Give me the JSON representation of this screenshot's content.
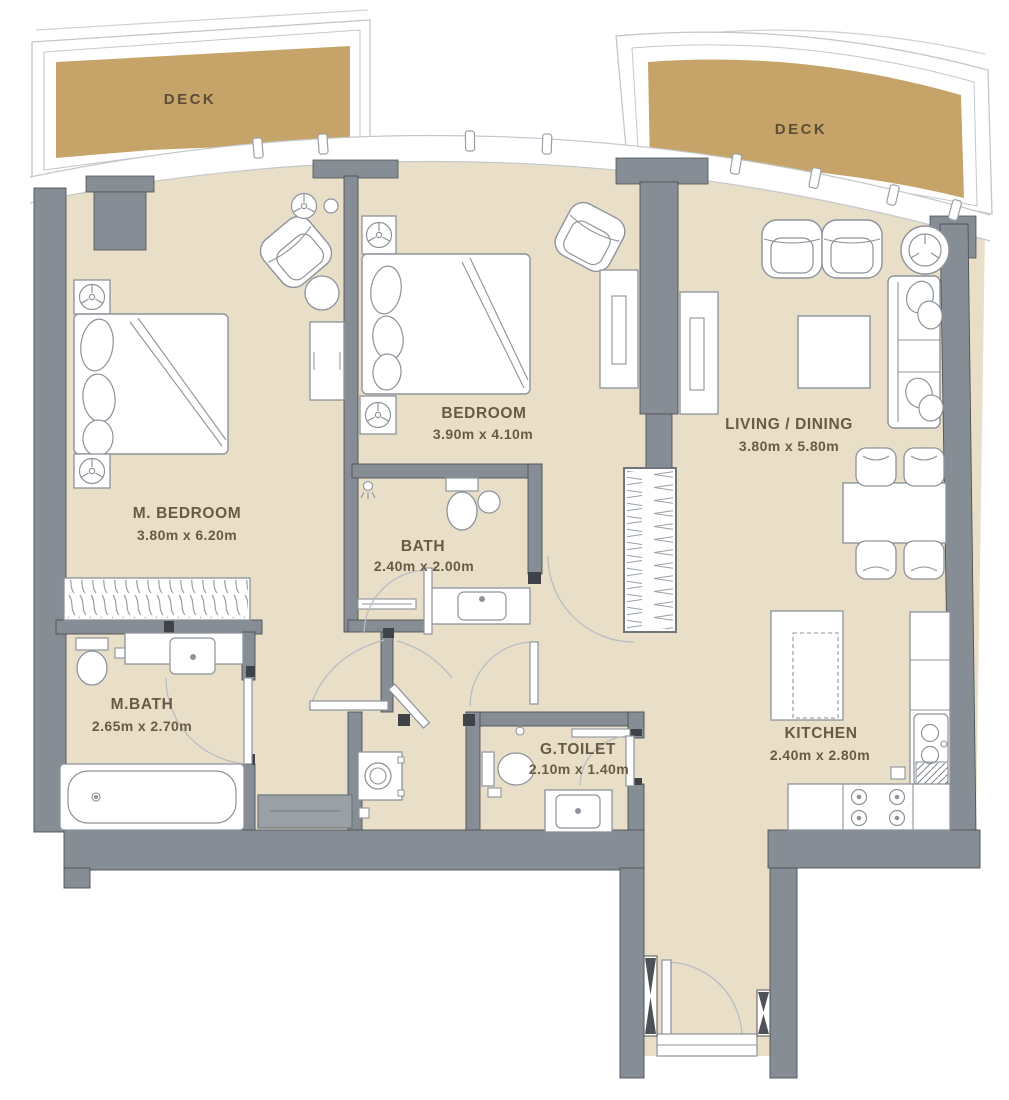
{
  "plan": {
    "decks": [
      {
        "label": "DECK"
      },
      {
        "label": "DECK"
      }
    ],
    "rooms": [
      {
        "name": "M. BEDROOM",
        "dims": "3.80m x 6.20m"
      },
      {
        "name": "BEDROOM",
        "dims": "3.90m x 4.10m"
      },
      {
        "name": "LIVING / DINING",
        "dims": "3.80m x 5.80m"
      },
      {
        "name": "BATH",
        "dims": "2.40m x 2.00m"
      },
      {
        "name": "M.BATH",
        "dims": "2.65m x 2.70m"
      },
      {
        "name": "G.TOILET",
        "dims": "2.10m x 1.40m"
      },
      {
        "name": "KITCHEN",
        "dims": "2.40m x 2.80m"
      }
    ]
  },
  "colors": {
    "deck": "#c6a469",
    "floor": "#e9dfc8",
    "wall": "#878d94",
    "wall_dark": "#4e5257",
    "cabinet": "#9aa0a5",
    "label": "#6a5a43",
    "deck_label": "#5d4d36",
    "outline": "#8d939b",
    "frame_line": "#c2c7cc"
  }
}
